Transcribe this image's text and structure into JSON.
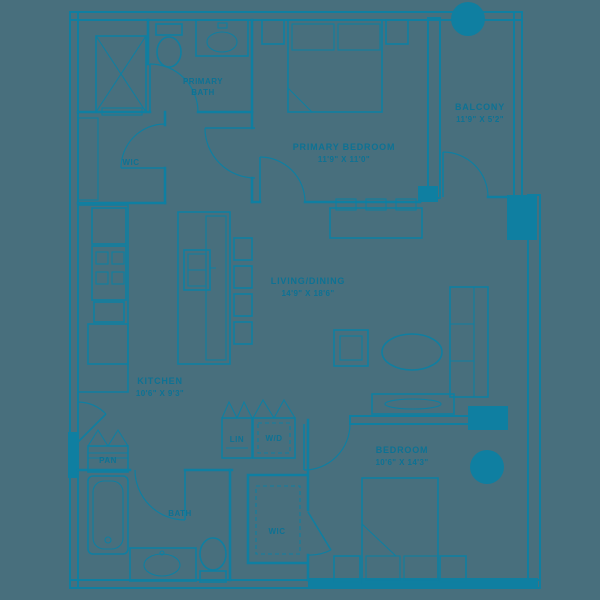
{
  "meta": {
    "colors": {
      "background": "#486f7d",
      "ink": "#0f7fa1",
      "text": "#0d7294"
    }
  },
  "rooms": {
    "primary_bath": {
      "label_line1": "PRIMARY",
      "label_line2": "BATH"
    },
    "wic_upper": {
      "label": "WIC"
    },
    "primary_bedroom": {
      "label": "PRIMARY BEDROOM",
      "dims": "11'9\" X 11'0\""
    },
    "balcony": {
      "label": "BALCONY",
      "dims": "11'9\" X 5'2\""
    },
    "living_dining": {
      "label": "LIVING/DINING",
      "dims": "14'9\" X 18'6\""
    },
    "kitchen": {
      "label": "KITCHEN",
      "dims": "10'6\" X 9'3\""
    },
    "pantry": {
      "label": "PAN"
    },
    "linen": {
      "label": "LIN"
    },
    "laundry": {
      "label": "W/D"
    },
    "bath": {
      "label": "BATH"
    },
    "wic_lower": {
      "label": "WIC"
    },
    "bedroom": {
      "label": "BEDROOM",
      "dims": "10'6\" X 14'3\""
    }
  }
}
